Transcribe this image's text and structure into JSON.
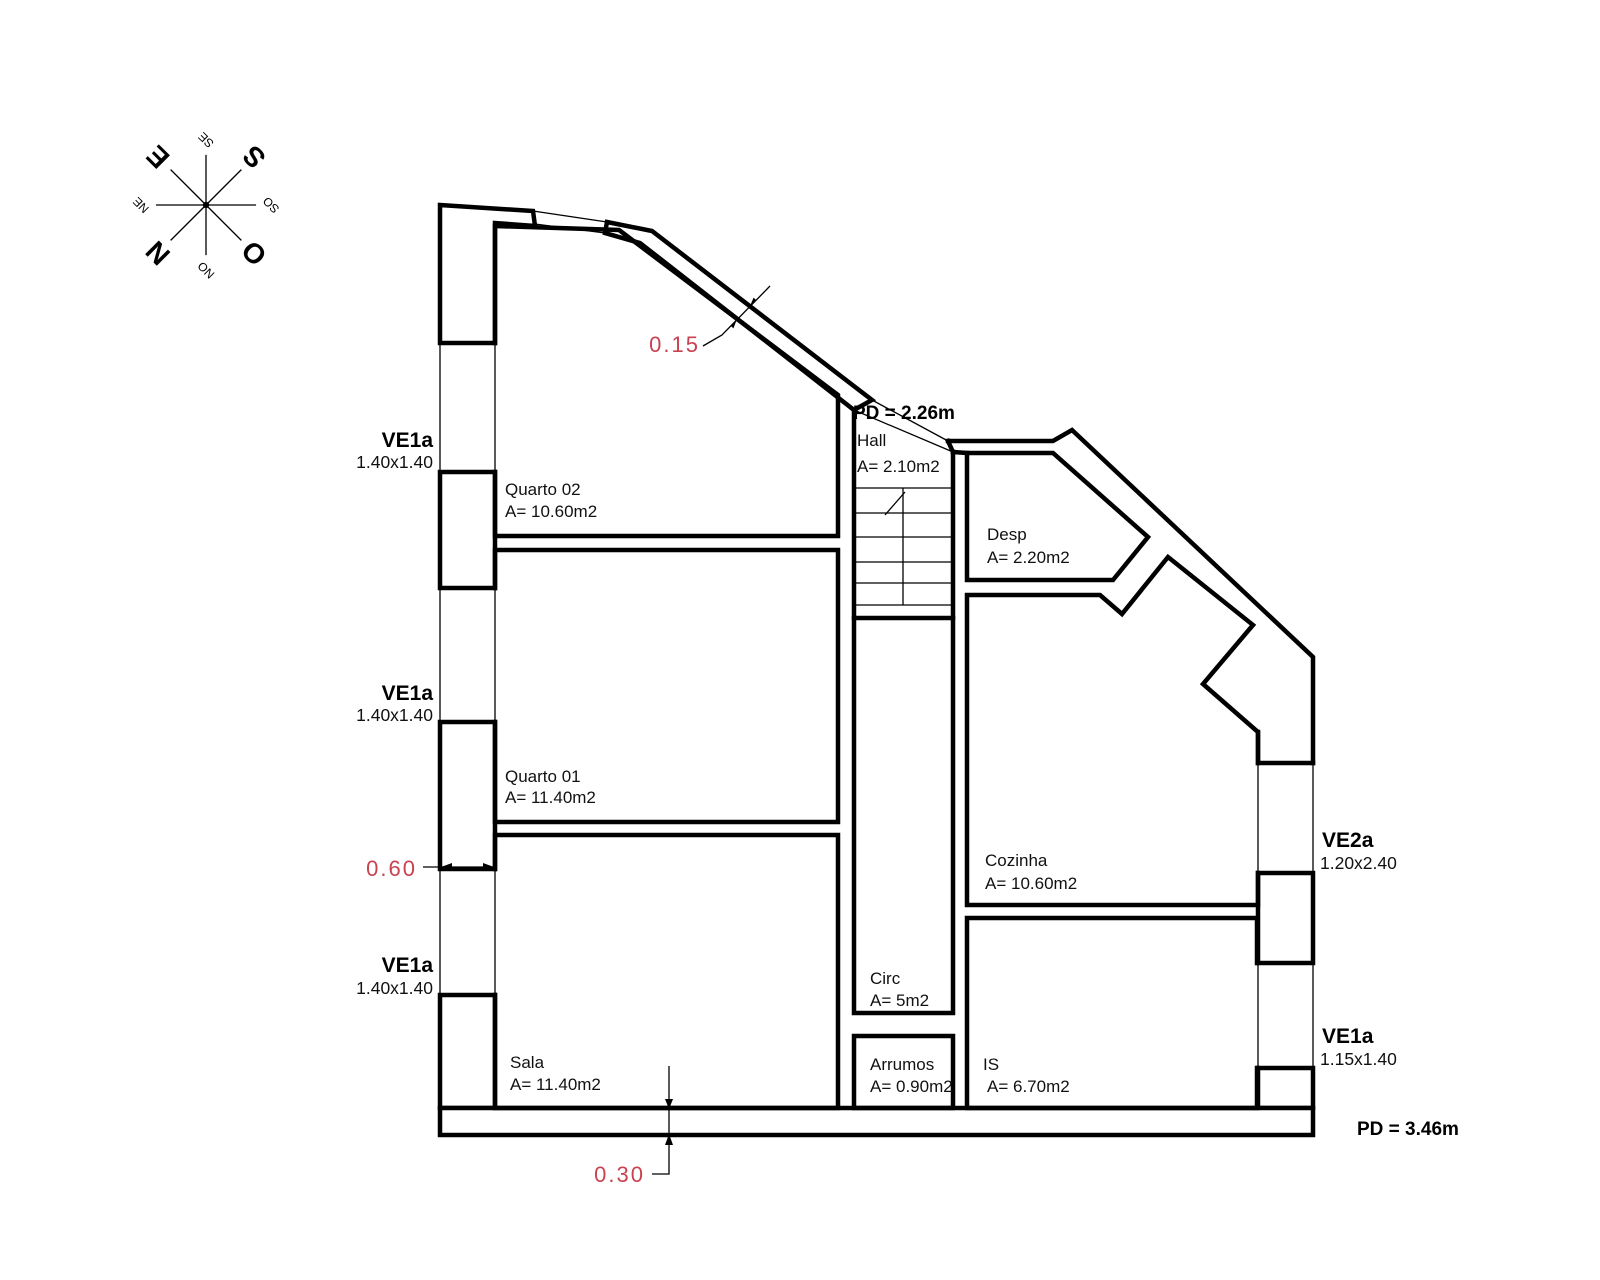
{
  "compass": {
    "n": "N",
    "s": "S",
    "e": "E",
    "o": "O",
    "ne": "NE",
    "se": "SE",
    "so": "SO",
    "no": "NO"
  },
  "rooms": {
    "quarto02": {
      "name": "Quarto 02",
      "area": "A= 10.60m2"
    },
    "quarto01": {
      "name": "Quarto 01",
      "area": "A= 11.40m2"
    },
    "sala": {
      "name": "Sala",
      "area": "A= 11.40m2"
    },
    "hall": {
      "name": "Hall",
      "area": "A= 2.10m2",
      "ceiling": "PD = 2.26m"
    },
    "desp": {
      "name": "Desp",
      "area": "A= 2.20m2"
    },
    "cozinha": {
      "name": "Cozinha",
      "area": "A= 10.60m2"
    },
    "circ": {
      "name": "Circ",
      "area": "A= 5m2"
    },
    "arrumos": {
      "name": "Arrumos",
      "area": "A= 0.90m2"
    },
    "is": {
      "name": "IS",
      "area": "A= 6.70m2"
    }
  },
  "windows": {
    "left1": {
      "code": "VE1a",
      "size": "1.40x1.40"
    },
    "left2": {
      "code": "VE1a",
      "size": "1.40x1.40"
    },
    "left3": {
      "code": "VE1a",
      "size": "1.40x1.40"
    },
    "right_top": {
      "code": "VE2a",
      "size": "1.20x2.40"
    },
    "right_bottom": {
      "code": "VE1a",
      "size": "1.15x1.40"
    }
  },
  "dimensions": {
    "diagonal_wall": "0.15",
    "left_wall": "0.60",
    "bottom_wall": "0.30"
  },
  "ceiling_main": "PD = 3.46m",
  "colors": {
    "line": "#000000",
    "dimension_text": "#c84250"
  }
}
